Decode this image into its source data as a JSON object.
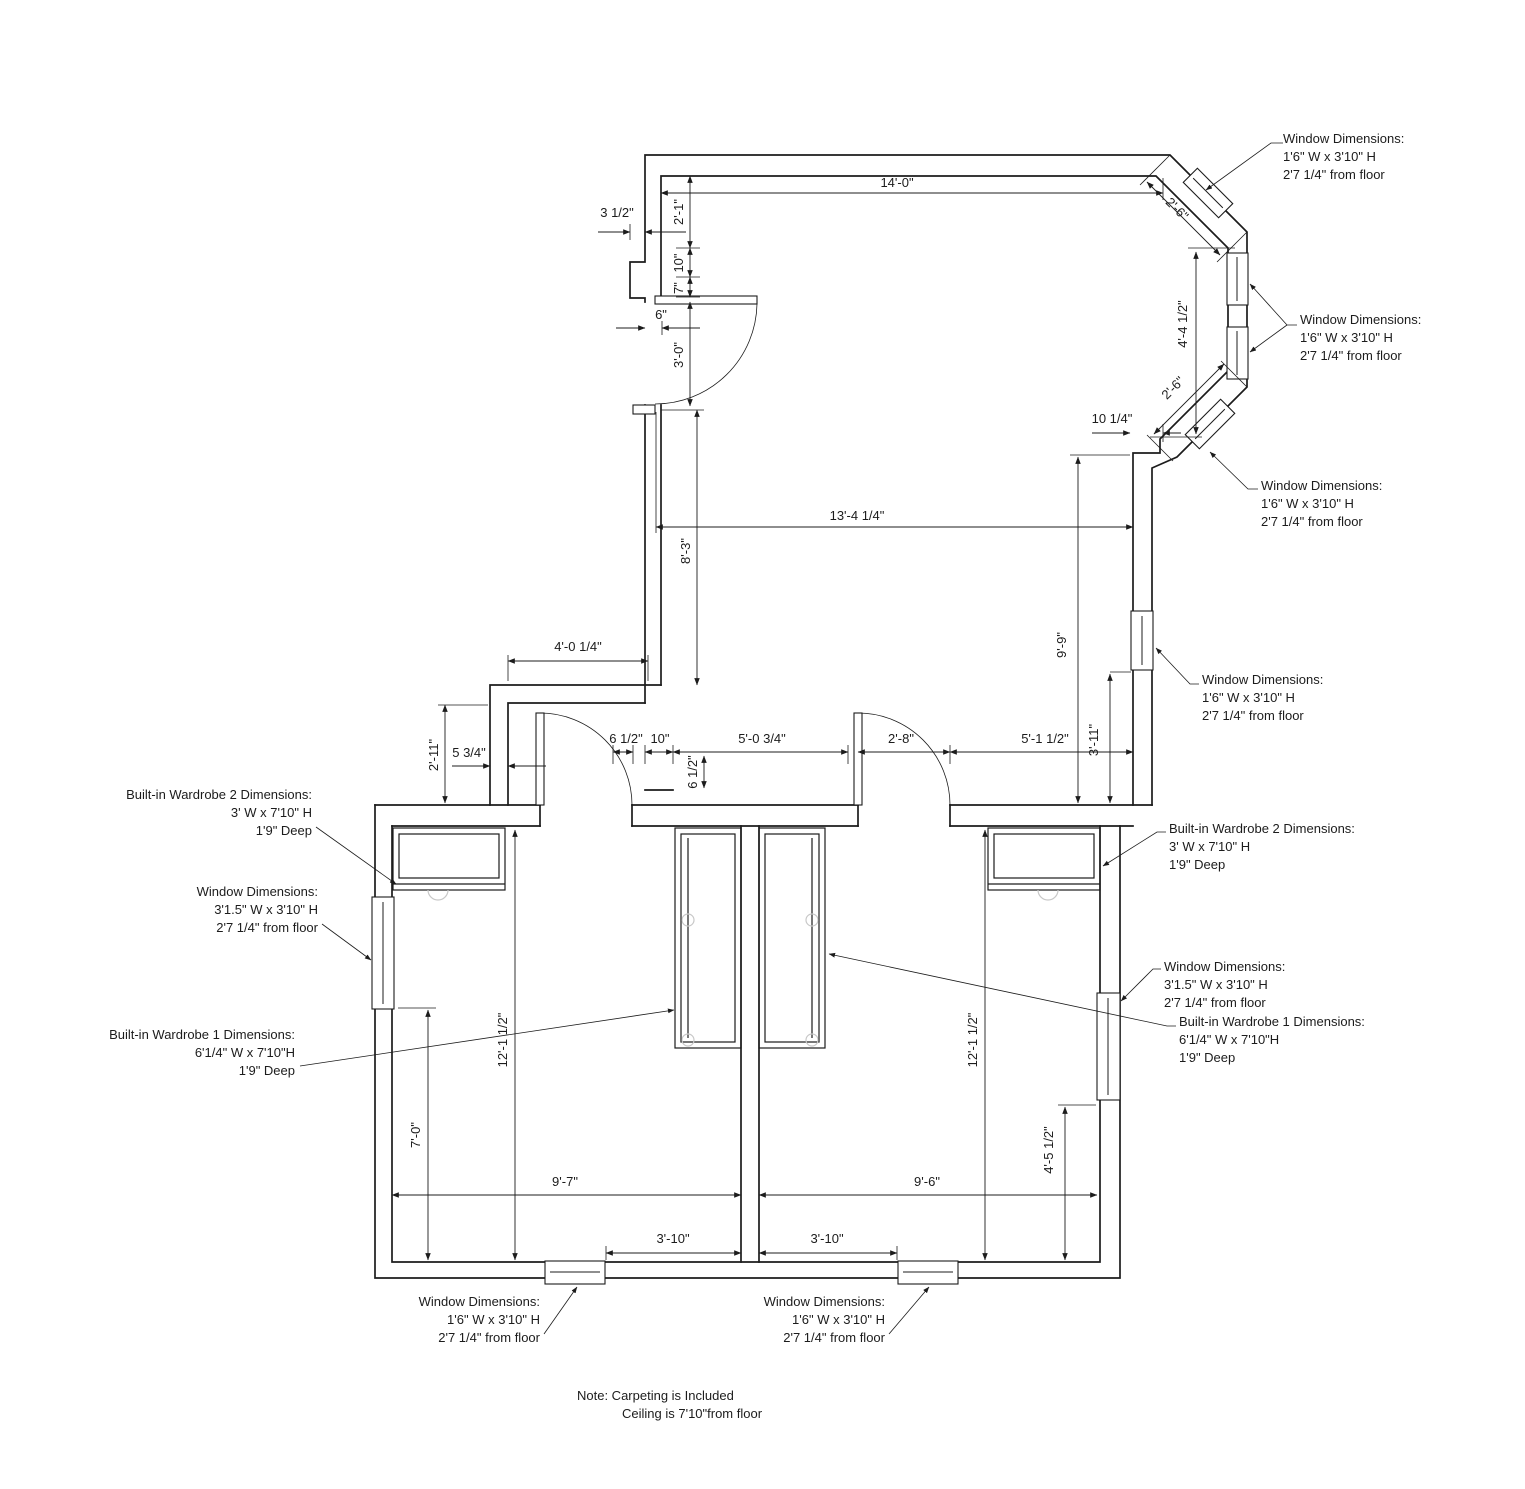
{
  "dims": {
    "d14": "14'-0\"",
    "d3_5": "3 1/2\"",
    "d2_1": "2'-1\"",
    "d10a": "10\"",
    "d7": "7\"",
    "d6": "6\"",
    "d3_0": "3'-0\"",
    "d13_4": "13'-4 1/4\"",
    "d8_3": "8'-3\"",
    "d9_9": "9'-9\"",
    "d10_14": "10 1/4\"",
    "d2_6a": "2'-6\"",
    "d4_4": "4'-4 1/2\"",
    "d2_6b": "2'-6\"",
    "d4_0": "4'-0 1/4\"",
    "d2_11": "2'-11\"",
    "d5_34": "5 3/4\"",
    "d6_12a": "6 1/2\"",
    "d10b": "10\"",
    "d5_0": "5'-0 3/4\"",
    "d2_8": "2'-8\"",
    "d5_1": "5'-1 1/2\"",
    "d6_12b": "6 1/2\"",
    "d3_11": "3'-11\"",
    "d12_1a": "12'-1 1/2\"",
    "d12_1b": "12'-1 1/2\"",
    "d7_0": "7'-0\"",
    "d4_5": "4'-5 1/2\"",
    "d9_7": "9'-7\"",
    "d9_6": "9'-6\"",
    "d3_10a": "3'-10\"",
    "d3_10b": "3'-10\""
  },
  "annotations": [
    {
      "lines": [
        "Window Dimensions:",
        "1'6\" W x 3'10\" H",
        "2'7 1/4\" from floor"
      ]
    },
    {
      "lines": [
        "Window Dimensions:",
        "1'6\" W x 3'10\" H",
        "2'7 1/4\" from floor"
      ]
    },
    {
      "lines": [
        "Window Dimensions:",
        "1'6\" W x 3'10\" H",
        "2'7 1/4\" from floor"
      ]
    },
    {
      "lines": [
        "Window Dimensions:",
        "1'6\" W x 3'10\" H",
        "2'7 1/4\" from floor"
      ]
    },
    {
      "lines": [
        "Built-in Wardrobe 2 Dimensions:",
        "3' W x 7'10\" H",
        "1'9\" Deep"
      ]
    },
    {
      "lines": [
        "Window Dimensions:",
        "3'1.5\" W x 3'10\" H",
        "2'7 1/4\" from floor"
      ]
    },
    {
      "lines": [
        "Built-in Wardrobe 1 Dimensions:",
        "6'1/4\" W x 7'10\"H",
        "1'9\" Deep"
      ]
    },
    {
      "lines": [
        "Built-in Wardrobe 2 Dimensions:",
        "3' W x 7'10\" H",
        "1'9\" Deep"
      ]
    },
    {
      "lines": [
        "Window Dimensions:",
        "3'1.5\" W x 3'10\" H",
        "2'7 1/4\" from floor"
      ]
    },
    {
      "lines": [
        "Built-in Wardrobe 1 Dimensions:",
        "6'1/4\" W x 7'10\"H",
        "1'9\" Deep"
      ]
    },
    {
      "lines": [
        "Window Dimensions:",
        "1'6\" W x 3'10\" H",
        "2'7 1/4\" from floor"
      ]
    },
    {
      "lines": [
        "Window Dimensions:",
        "1'6\" W x 3'10\" H",
        "2'7 1/4\" from floor"
      ]
    }
  ],
  "note": {
    "l1": "Note: Carpeting is Included",
    "l2": "Ceiling is 7'10\"from floor"
  }
}
